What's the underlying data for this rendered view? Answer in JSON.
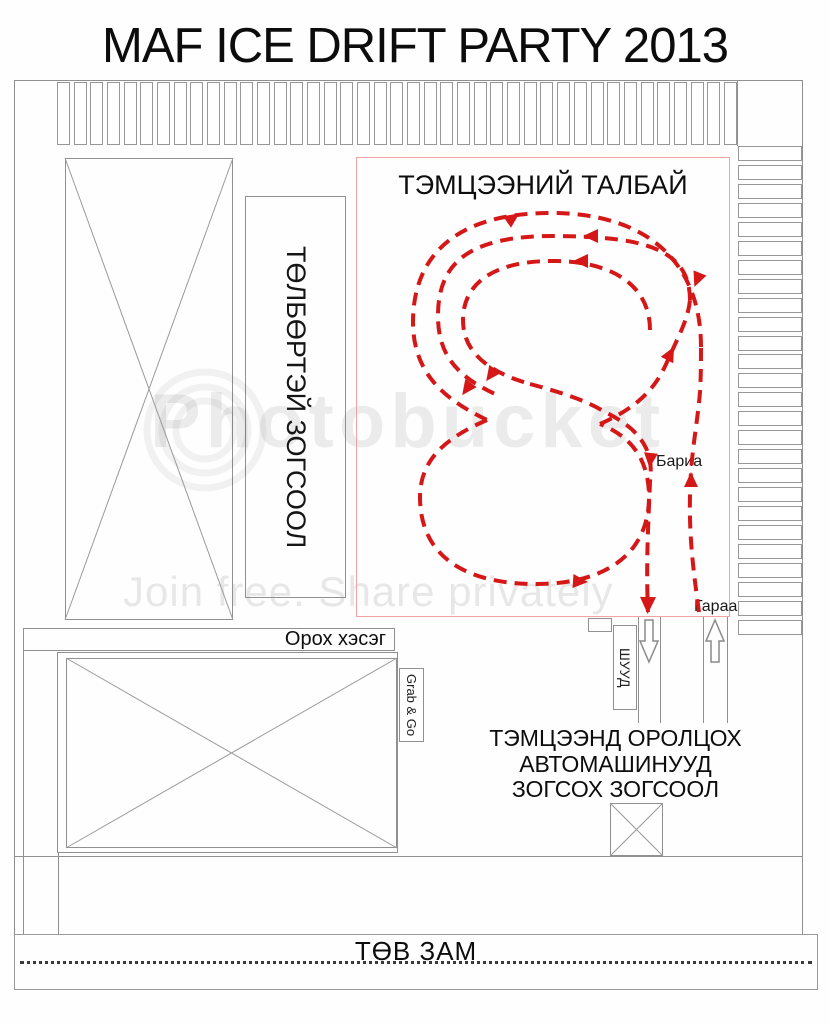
{
  "title": "MAF ICE DRIFT PARTY 2013",
  "competition_area": {
    "title": "ТЭМЦЭЭНИЙ ТАЛБАЙ",
    "finish_label": "Бариа",
    "start_label": "Гараа"
  },
  "labels": {
    "paid_parking": "ТӨЛБӨРТЭЙ ЗОГСООЛ",
    "entry_section": "Орох хэсэг",
    "grab_and_go": "Grab & Go",
    "direct_lane": "ШУУД",
    "participants_parking_line1": "ТЭМЦЭЭНД ОРОЛЦОХ",
    "participants_parking_line2": "АВТОМАШИНУУД",
    "participants_parking_line3": "ЗОГСОХ ЗОГСООЛ",
    "main_road": "ТӨВ ЗАМ"
  },
  "parking": {
    "top_row_slots": 41,
    "right_column_slots": 26
  },
  "watermark": {
    "brand": "Photobucket",
    "tagline": "Join free. Share privately"
  },
  "colors": {
    "track_red": "#d51717",
    "area_border_red": "#f0a3a3",
    "line_gray": "#909090"
  }
}
